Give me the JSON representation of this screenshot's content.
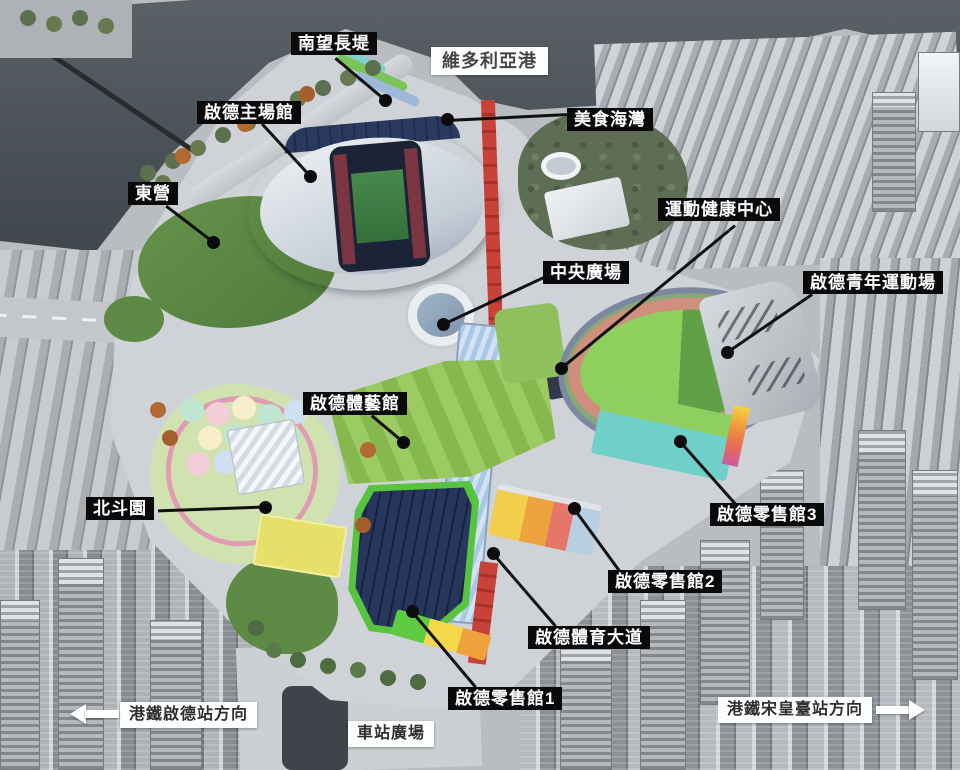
{
  "map": {
    "annotations": {
      "promenade": {
        "label": "南望長堤"
      },
      "harbour": {
        "label": "維多利亞港"
      },
      "stadium": {
        "label": "啟德主場館"
      },
      "food_bay": {
        "label": "美食海灣"
      },
      "east_camp": {
        "label": "東營"
      },
      "health_centre": {
        "label": "運動健康中心"
      },
      "central_plaza": {
        "label": "中央廣場"
      },
      "youth_ground": {
        "label": "啟德青年運動場"
      },
      "arena": {
        "label": "啟德體藝館"
      },
      "north_star_park": {
        "label": "北斗園"
      },
      "retail3": {
        "label": "啟德零售館3"
      },
      "retail2": {
        "label": "啟德零售館2"
      },
      "sports_avenue": {
        "label": "啟德體育大道"
      },
      "retail1": {
        "label": "啟德零售館1"
      },
      "station_square": {
        "label": "車站廣場"
      },
      "mtr_kai_tak": {
        "label": "港鐵啟德站方向",
        "arrow": "left"
      },
      "mtr_sung_wong_toi": {
        "label": "港鐵宋皇臺站方向",
        "arrow": "right"
      }
    },
    "colors": {
      "label_bg": "#0a0a0a",
      "label_fg": "#ffffff",
      "white_label_bg": "#fcfdfd",
      "white_label_fg": "#2f2f2f",
      "water": "#4a5157",
      "stadium_rim_purple": "#6b79c0",
      "stadium_rim_pink": "#c78a9b",
      "pitch_green": "#47894b",
      "running_track": "#cf8f7c",
      "field_green": "#8ed05e",
      "red_avenue": "#c8423a",
      "canopy_blue": "#a9c8e6",
      "solar_roof": "#1f2a47",
      "lawn_green": "#5f8c46",
      "teal_building": "#6fd0ca",
      "city_grey": "#b9bdc1"
    }
  }
}
